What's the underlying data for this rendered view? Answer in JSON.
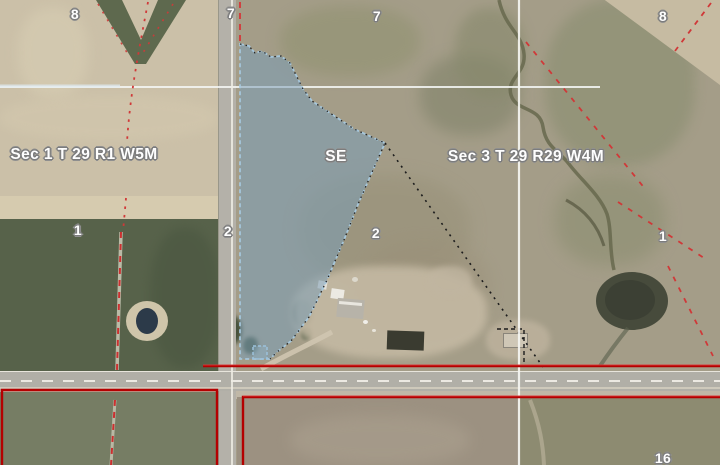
{
  "map": {
    "section_labels": [
      {
        "text": "Sec 1 T 29 R1 W5M"
      },
      {
        "text": "Sec 3 T 29 R29 W4M"
      }
    ],
    "quarter_section_label": {
      "text": "SE"
    },
    "section_numbers": [
      {
        "text": "8"
      },
      {
        "text": "7"
      },
      {
        "text": "7"
      },
      {
        "text": "8"
      },
      {
        "text": "1"
      },
      {
        "text": "2"
      },
      {
        "text": "2"
      },
      {
        "text": "1"
      },
      {
        "text": "16"
      }
    ],
    "colors": {
      "parcel_highlight_fill": "#7da2b9",
      "parcel_outline_blue": "#a6c8de",
      "boundary_red": "#b40000",
      "quarter_line_white": "#ffffff",
      "trail_red_dashed": "#d03838",
      "survey_dotted_black": "#1c1c1c"
    }
  }
}
